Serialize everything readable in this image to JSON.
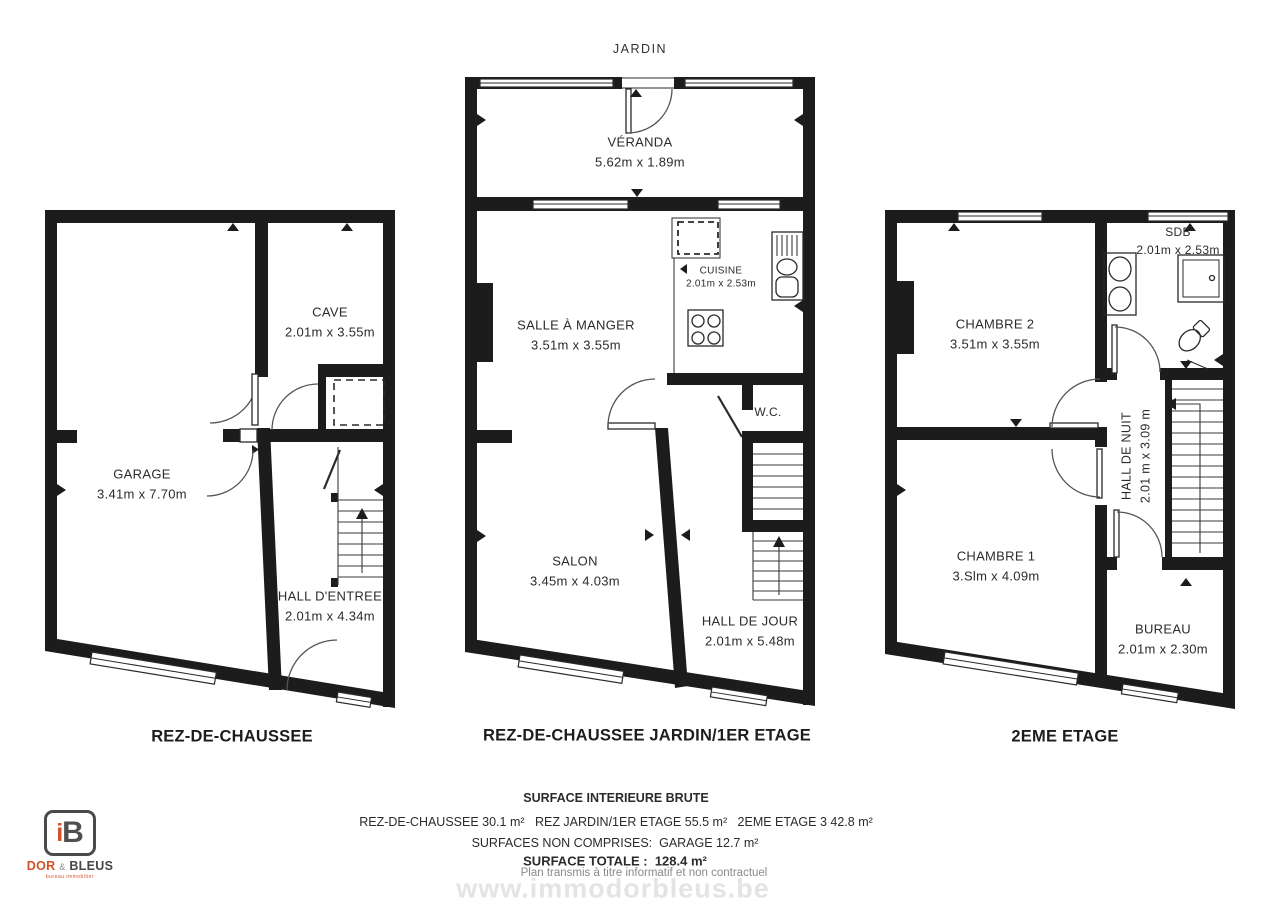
{
  "header": {
    "garden_label": "JARDIN"
  },
  "plans": [
    {
      "title": "REZ-DE-CHAUSSEE",
      "rooms": [
        {
          "name": "GARAGE",
          "dims": "3.41m x 7.70m"
        },
        {
          "name": "CAVE",
          "dims": "2.01m x 3.55m"
        },
        {
          "name": "HALL D'ENTREE",
          "dims": "2.01m x 4.34m"
        }
      ]
    },
    {
      "title": "REZ-DE-CHAUSSEE JARDIN/1ER ETAGE",
      "rooms": [
        {
          "name": "VÉRANDA",
          "dims": "5.62m x 1.89m"
        },
        {
          "name": "SALLE À MANGER",
          "dims": "3.51m x 3.55m"
        },
        {
          "name": "CUISINE",
          "dims": "2.01m x 2.53m"
        },
        {
          "name": "W.C.",
          "dims": ""
        },
        {
          "name": "SALON",
          "dims": "3.45m x 4.03m"
        },
        {
          "name": "HALL DE JOUR",
          "dims": "2.01m x 5.48m"
        }
      ]
    },
    {
      "title": "2EME ETAGE",
      "rooms": [
        {
          "name": "CHAMBRE 2",
          "dims": "3.51m x 3.55m"
        },
        {
          "name": "SDB",
          "dims": "2.01m x 2.53m"
        },
        {
          "name": "HALL DE NUIT",
          "dims": "2.01 m x 3.09 m"
        },
        {
          "name": "CHAMBRE 1",
          "dims": "3.Slm x 4.09m"
        },
        {
          "name": "BUREAU",
          "dims": "2.01m x 2.30m"
        }
      ]
    }
  ],
  "footer": {
    "surface_title": "SURFACE INTERIEURE BRUTE",
    "surfaces_line": "REZ-DE-CHAUSSEE 30.1 m²   REZ JARDIN/1ER ETAGE 55.5 m²   2EME ETAGE 3 42.8 m²",
    "excluded_line": "SURFACES NON COMPRISES:  GARAGE 12.7 m²",
    "total_line": "SURFACE TOTALE :  128.4 m²",
    "disclaimer": "Plan transmis à titre informatif et non contractuel",
    "watermark": "www.immodorbleus.be"
  },
  "logo": {
    "monogram_i": "i",
    "monogram_b": "B",
    "name_dor": "DOR",
    "name_amp": "&",
    "name_bleus": "BLEUS",
    "tagline": "bureau immobilier",
    "accent_color": "#d4502a",
    "dark_color": "#4a4a4a"
  }
}
